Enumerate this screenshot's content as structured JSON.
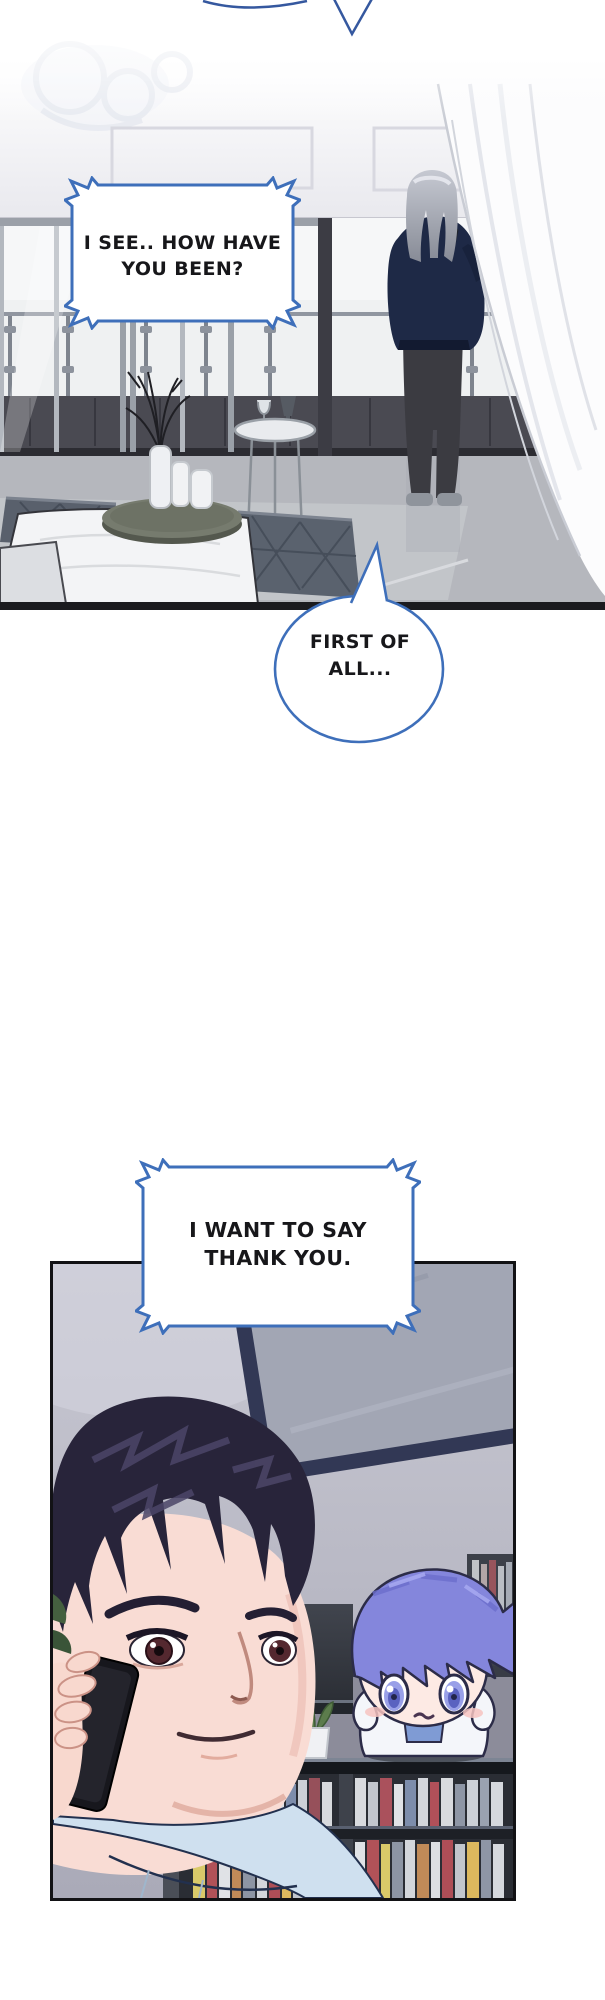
{
  "speech": {
    "box1": {
      "lines": [
        "I SEE.. HOW HAVE",
        "YOU BEEN?"
      ]
    },
    "round": {
      "lines": [
        "FIRST OF",
        "ALL..."
      ]
    },
    "box2": {
      "lines": [
        "I WANT TO SAY",
        "THANK YOU."
      ]
    }
  },
  "colors": {
    "bubble-border": "#3e6fba",
    "tail-blue": "#35589f",
    "ink": "#17171a",
    "panel-border": "#121215",
    "page-bg": "#ffffff"
  }
}
